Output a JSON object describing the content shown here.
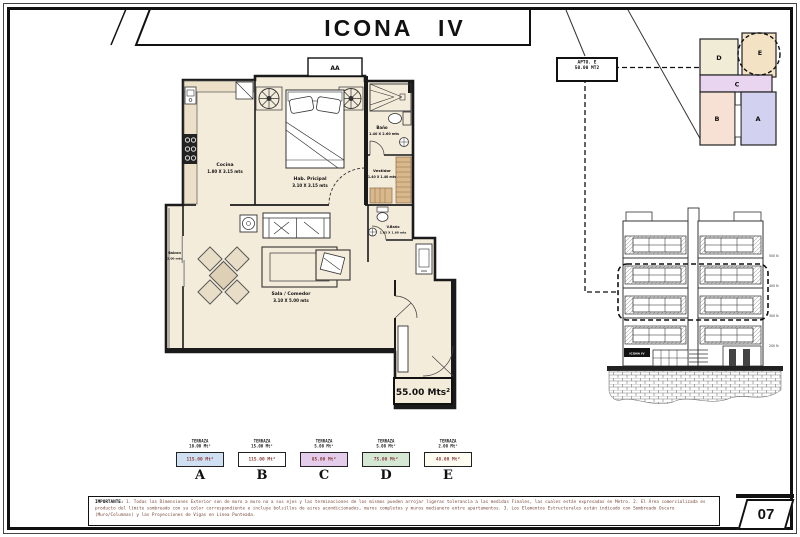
{
  "page": {
    "title": "ICONA IV",
    "page_number": "07"
  },
  "callout": {
    "line1": "APTO. E",
    "line2": "50.00 MT2"
  },
  "keyplan": {
    "units": [
      {
        "letter": "D",
        "color": "#f1ecd6"
      },
      {
        "letter": "E",
        "color": "#f3e2c4"
      },
      {
        "letter": "C",
        "color": "#e9d5ef"
      },
      {
        "letter": "B",
        "color": "#f7e0d4"
      },
      {
        "letter": "A",
        "color": "#d2d2f0"
      }
    ]
  },
  "floorplan": {
    "aa_label": "AA",
    "total_area": "55.00 Mts²",
    "floor_color": "#f4ecdb",
    "wall_color": "#1a1a1a",
    "wood_color": "#d9b98c",
    "rooms": [
      {
        "name": "Cocina",
        "dims": "1.80 X 3.15 mts"
      },
      {
        "name": "Hab. Pricipal",
        "dims": "3.10 X 3.15 mts"
      },
      {
        "name": "Baño",
        "dims": "1.40 X 2.60 mts"
      },
      {
        "name": "Vestidor",
        "dims": "1.40 X 1.40 mts"
      },
      {
        "name": "V.Baño",
        "dims": "1.05 X 1.60 mts"
      },
      {
        "name": "Sala / Comedor",
        "dims": "3.10 X 5.00 mts"
      },
      {
        "name": "Balcon",
        "dims": "2.00 mts"
      }
    ]
  },
  "elevation": {
    "sign": "ICONA IV",
    "levels": [
      "500 N",
      "400 N",
      "300 N",
      "200 N"
    ]
  },
  "legend": {
    "terraza_label": "TERRAZA",
    "items": [
      {
        "letter": "A",
        "terraza": "10.00 Mt²",
        "area": "115.00 Mt²",
        "color": "#cfe0f2"
      },
      {
        "letter": "B",
        "terraza": "15.00 Mt²",
        "area": "115.00 Mt²",
        "color": "#ffffff"
      },
      {
        "letter": "C",
        "terraza": "5.00 Mt²",
        "area": "85.00 Mt²",
        "color": "#e3cdea"
      },
      {
        "letter": "D",
        "terraza": "5.00 Mt²",
        "area": "75.00 Mt²",
        "color": "#d5e8d4"
      },
      {
        "letter": "E",
        "terraza": "2.00 Mt²",
        "area": "48.00 Mt²",
        "color": "#fffdf2"
      }
    ]
  },
  "note": {
    "heading": "IMPORTANTE:",
    "body": " 1. Todas las Dimensiones Exterior son de muro a muro no a sus ejes y las terminaciones de los mismos pueden arrojar ligeras tolerancia a las medidas Finales, las cuales están expresadas en Metro. 2. El Área comercializada es producto del límite sombreado con su color correspondiente e incluye bolsillos de aires acondicionados, muros completos y muros medianero entre apartamentos. 3. Los Elementos Estructurales están indicado con Sombreado Oscuro (Muro/Columnas) y las Proyecciones de Vigas en Línea Punteada."
  }
}
